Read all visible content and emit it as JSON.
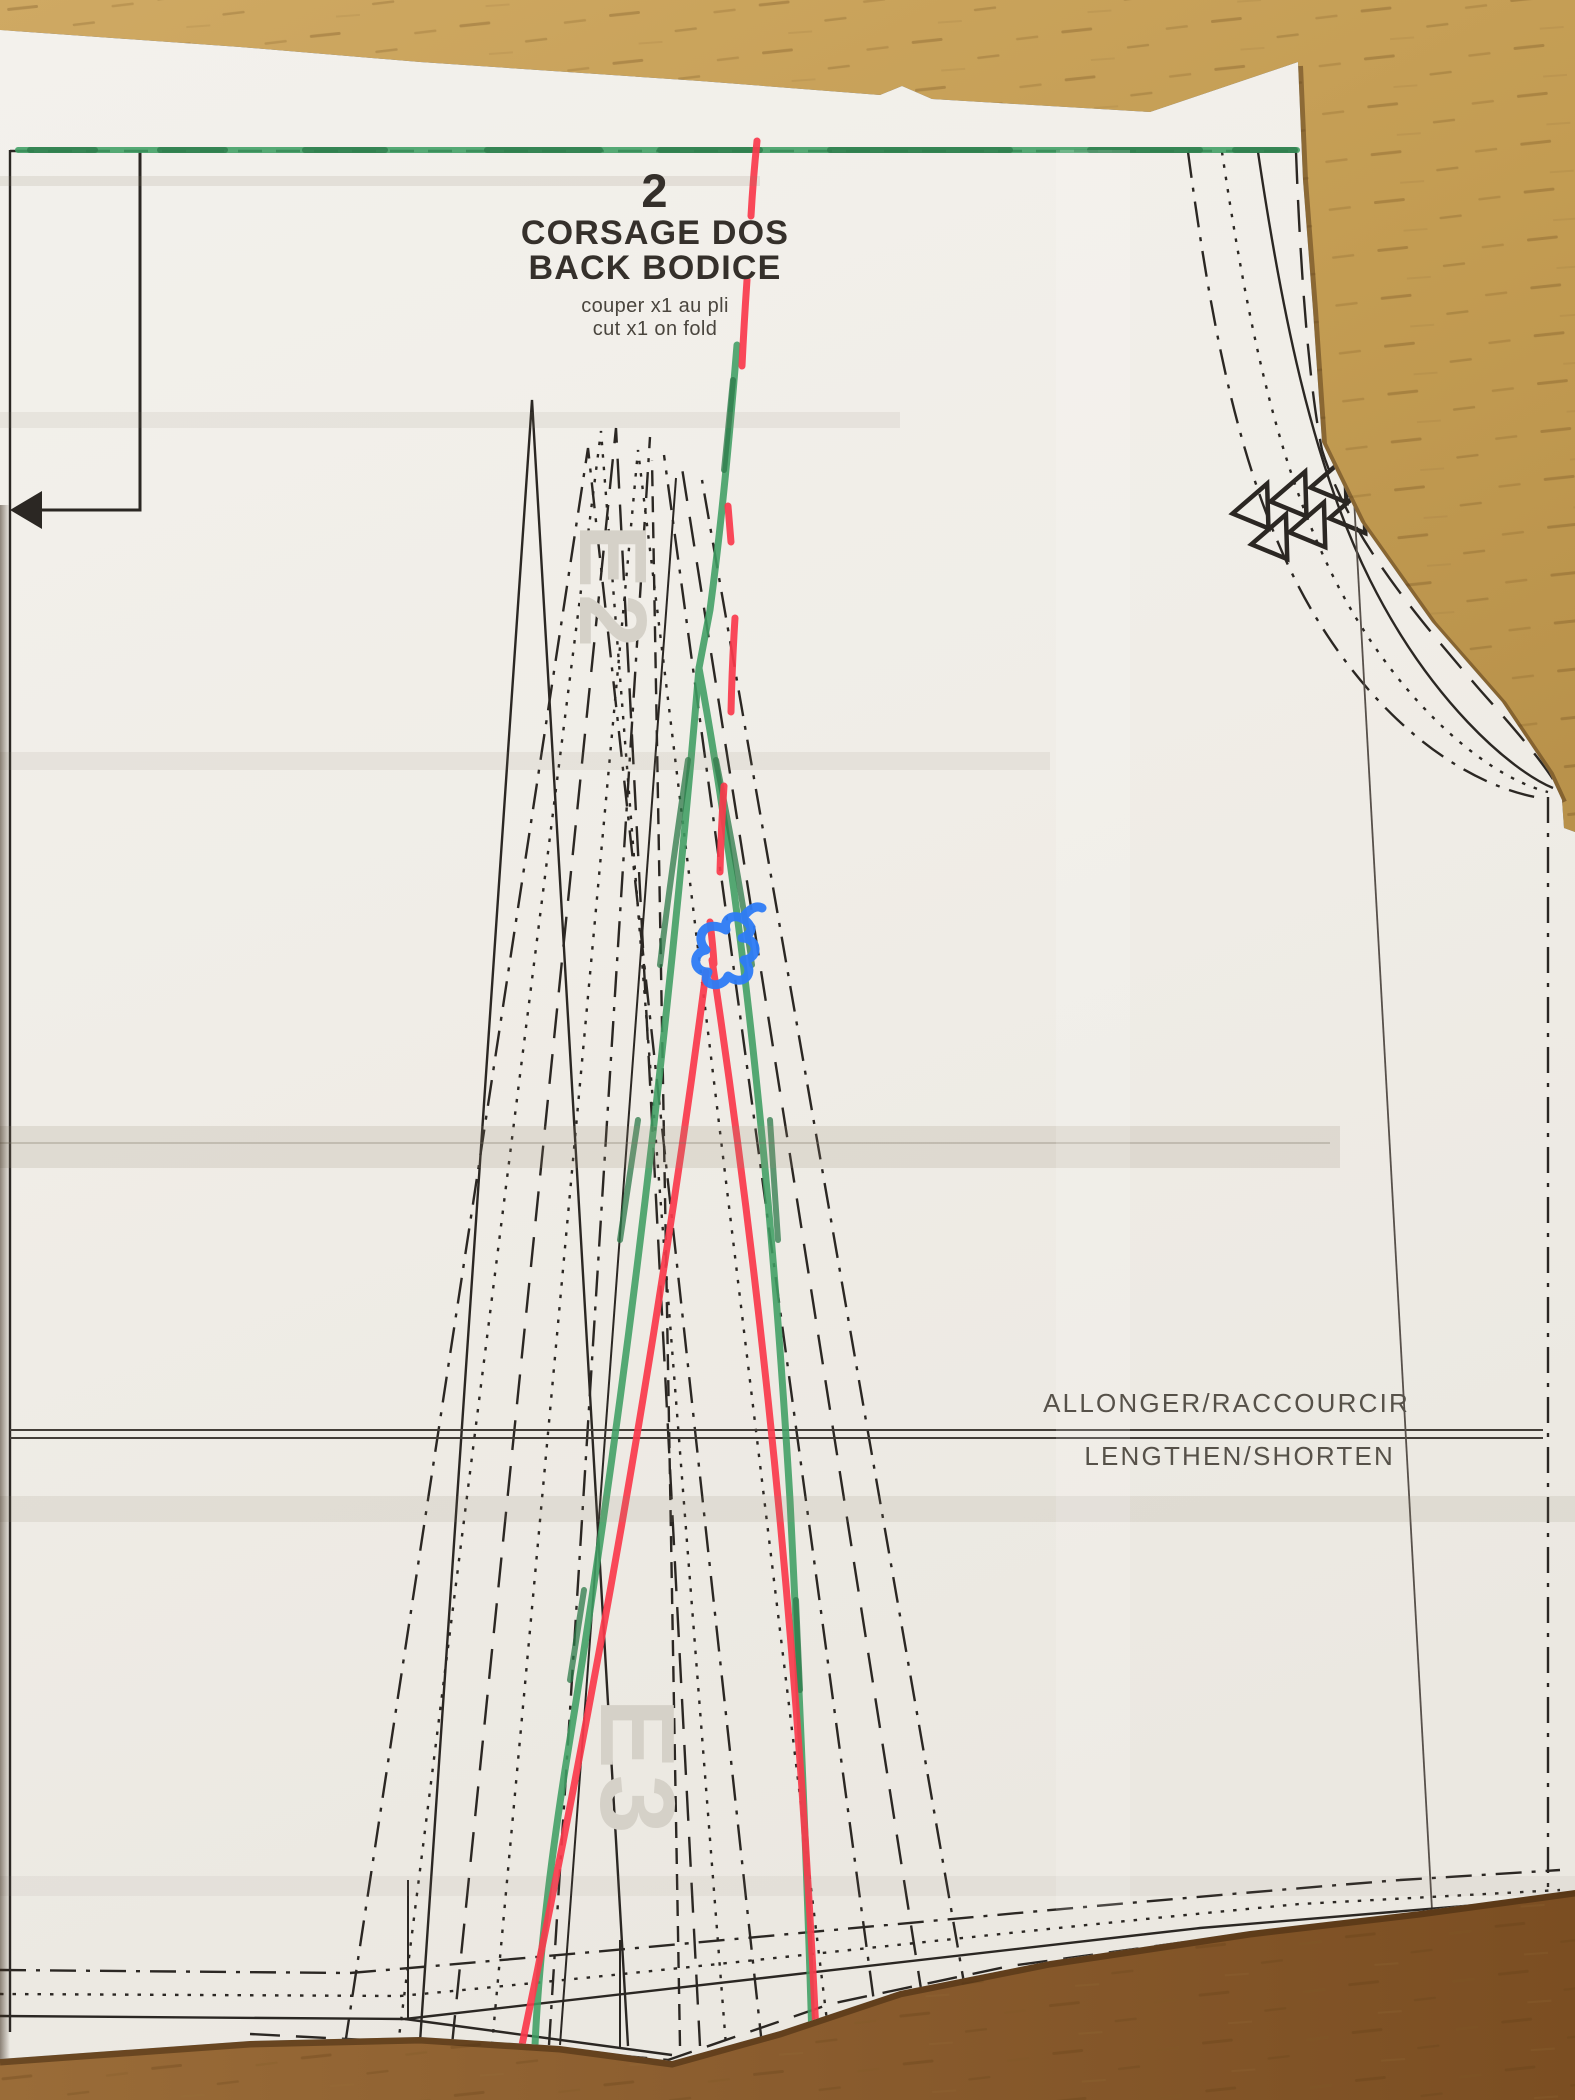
{
  "pattern": {
    "piece_number": "2",
    "title_fr": "CORSAGE DOS",
    "title_en": "BACK BODICE",
    "cutting_instruction_fr": "couper x1 au pli",
    "cutting_instruction_en": "cut x1 on fold",
    "adjustment_label_fr": "ALLONGER/RACCOURCIR",
    "adjustment_label_en": "LENGTHEN/SHORTEN",
    "watermark_upper": "E2",
    "watermark_lower": "E3"
  },
  "colors": {
    "marker_red": "#fa3a4c",
    "marker_green": "#3f9e63",
    "marker_green_dark": "#2c7a49",
    "marker_blue": "#2e7cf6",
    "ink": "#2b2723",
    "label_grey": "#565149",
    "watermark_grey": "#d5d1c8",
    "paper": "#f0ede7",
    "wood_light": "#c6a057",
    "wood_dark": "#855728"
  }
}
